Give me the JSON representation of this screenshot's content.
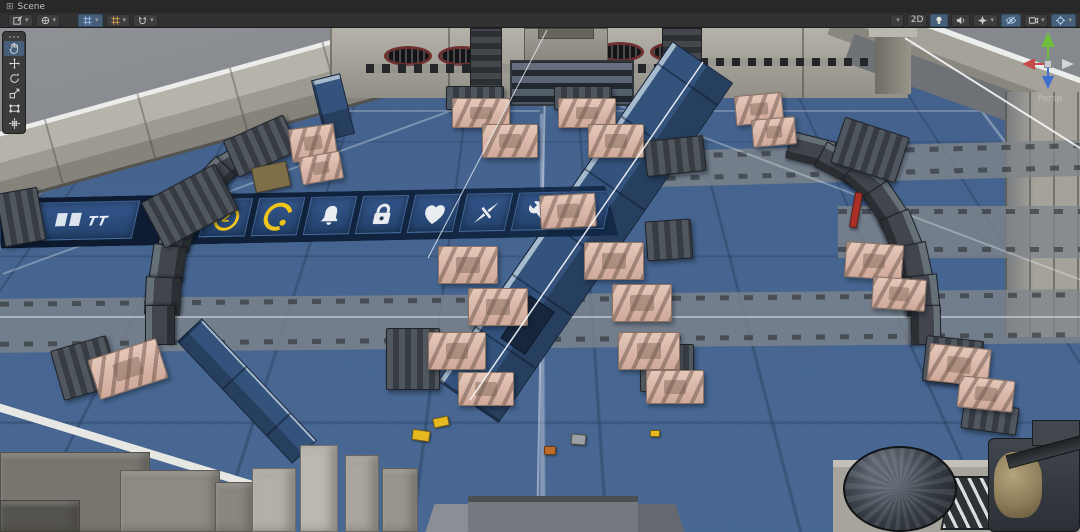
{
  "editor": {
    "tab": {
      "label": "Scene"
    },
    "toolbar": {
      "left": [
        {
          "name": "scene-tool-dropdown",
          "icon": "pencil-square-icon",
          "caret": true
        },
        {
          "name": "gizmo-tool-dropdown",
          "icon": "gizmo-icon",
          "caret": true
        },
        {
          "name": "grid-visibility-dropdown",
          "icon": "grid-icon",
          "active": true,
          "caret": true
        },
        {
          "name": "grid-snap-dropdown",
          "icon": "grid-orange-icon",
          "caret": true
        },
        {
          "name": "snap-settings-dropdown",
          "icon": "magnet-icon",
          "caret": true
        }
      ],
      "right": [
        {
          "name": "shading-mode-dropdown",
          "icon": "sphere-icon",
          "caret": true
        },
        {
          "name": "2d-toggle",
          "label": "2D"
        },
        {
          "name": "lighting-toggle",
          "icon": "bulb-icon",
          "active": true
        },
        {
          "name": "audio-toggle",
          "icon": "speaker-icon"
        },
        {
          "name": "effects-dropdown",
          "icon": "star-icon",
          "caret": true
        },
        {
          "name": "visibility-toggle",
          "icon": "eye-slash-icon",
          "active": true
        },
        {
          "name": "camera-dropdown",
          "icon": "camera-grid-icon",
          "caret": true
        },
        {
          "name": "gizmos-dropdown",
          "icon": "crosshair-icon",
          "active": true,
          "caret": true
        }
      ]
    },
    "tools": {
      "items": [
        {
          "name": "hand",
          "active": true
        },
        {
          "name": "move"
        },
        {
          "name": "rotate"
        },
        {
          "name": "scale"
        },
        {
          "name": "rect"
        },
        {
          "name": "transform"
        }
      ]
    },
    "view_gizmo": {
      "label": "Persp",
      "axis_colors": {
        "up_y": "#6fbf3f",
        "left_x": "#c84b4b",
        "down_z": "#3e6fd0",
        "right": "#d2d5d9"
      }
    }
  },
  "scene": {
    "palette": {
      "floor_blue": "#4a6a96",
      "wall_concrete": "#a5a29a",
      "outside_gray": "#8b8e92",
      "tank_pink": "#d9b3a4",
      "vehicle_dark": "#3a3f45",
      "banner_navy": "#142e4e",
      "tile_blue": "#2c4e7c",
      "accent_yellow": "#f0c419",
      "vent_red": "#6e2f2f",
      "marker_red": "#ab2f26"
    },
    "banner": {
      "text_left": "TT",
      "text_right": "ctrol",
      "icons": [
        {
          "name": "coin-2-icon",
          "value": "2"
        },
        {
          "name": "coin-arc-icon"
        },
        {
          "name": "bell-icon"
        },
        {
          "name": "lock-icon"
        },
        {
          "name": "heart-icon"
        },
        {
          "name": "dart-icon"
        },
        {
          "name": "wrench-icon"
        }
      ]
    },
    "tanks": [
      {
        "x": 290,
        "y": 126,
        "w": 46,
        "h": 34,
        "r": -8
      },
      {
        "x": 300,
        "y": 154,
        "w": 42,
        "h": 28,
        "r": -10
      },
      {
        "x": 452,
        "y": 98,
        "w": 58,
        "h": 30,
        "r": 0
      },
      {
        "x": 482,
        "y": 124,
        "w": 56,
        "h": 34,
        "r": 0
      },
      {
        "x": 558,
        "y": 98,
        "w": 58,
        "h": 30,
        "r": 0
      },
      {
        "x": 588,
        "y": 124,
        "w": 56,
        "h": 34,
        "r": 0
      },
      {
        "x": 735,
        "y": 94,
        "w": 48,
        "h": 30,
        "r": -5
      },
      {
        "x": 752,
        "y": 118,
        "w": 44,
        "h": 28,
        "r": -5
      },
      {
        "x": 438,
        "y": 246,
        "w": 60,
        "h": 38,
        "r": 0
      },
      {
        "x": 468,
        "y": 288,
        "w": 60,
        "h": 38,
        "r": 0
      },
      {
        "x": 584,
        "y": 242,
        "w": 60,
        "h": 38,
        "r": 0
      },
      {
        "x": 612,
        "y": 284,
        "w": 60,
        "h": 38,
        "r": 0
      },
      {
        "x": 428,
        "y": 332,
        "w": 58,
        "h": 38,
        "r": 0
      },
      {
        "x": 458,
        "y": 372,
        "w": 56,
        "h": 34,
        "r": 0
      },
      {
        "x": 618,
        "y": 332,
        "w": 62,
        "h": 38,
        "r": 0
      },
      {
        "x": 646,
        "y": 370,
        "w": 58,
        "h": 34,
        "r": 0
      },
      {
        "x": 92,
        "y": 348,
        "w": 72,
        "h": 42,
        "r": -18
      },
      {
        "x": 845,
        "y": 243,
        "w": 58,
        "h": 36,
        "r": 4
      },
      {
        "x": 872,
        "y": 278,
        "w": 54,
        "h": 32,
        "r": 4
      },
      {
        "x": 928,
        "y": 346,
        "w": 62,
        "h": 38,
        "r": 6
      },
      {
        "x": 958,
        "y": 378,
        "w": 56,
        "h": 32,
        "r": 6
      },
      {
        "x": 540,
        "y": 194,
        "w": 56,
        "h": 34,
        "r": -3
      }
    ],
    "vehicles": [
      {
        "x": 148,
        "y": 180,
        "w": 84,
        "h": 52,
        "r": -28
      },
      {
        "x": 228,
        "y": 126,
        "w": 66,
        "h": 40,
        "r": -24
      },
      {
        "x": 446,
        "y": 86,
        "w": 58,
        "h": 24,
        "r": 0
      },
      {
        "x": 554,
        "y": 86,
        "w": 58,
        "h": 24,
        "r": 0
      },
      {
        "x": 645,
        "y": 138,
        "w": 60,
        "h": 36,
        "r": -6
      },
      {
        "x": 386,
        "y": 328,
        "w": 54,
        "h": 62,
        "r": 0
      },
      {
        "x": 640,
        "y": 344,
        "w": 54,
        "h": 48,
        "r": 0
      },
      {
        "x": 56,
        "y": 342,
        "w": 58,
        "h": 52,
        "r": -16
      },
      {
        "x": 924,
        "y": 338,
        "w": 58,
        "h": 46,
        "r": 6
      },
      {
        "x": 836,
        "y": 126,
        "w": 68,
        "h": 48,
        "r": 18
      },
      {
        "x": 646,
        "y": 220,
        "w": 46,
        "h": 40,
        "r": -4
      },
      {
        "x": 0,
        "y": 190,
        "w": 42,
        "h": 54,
        "r": -10
      },
      {
        "x": 962,
        "y": 404,
        "w": 56,
        "h": 28,
        "r": 8
      }
    ],
    "barrier_left": [
      {
        "x": 240,
        "y": 134,
        "w": 44,
        "h": 26,
        "r": -18
      },
      {
        "x": 214,
        "y": 148,
        "w": 42,
        "h": 26,
        "r": -32
      },
      {
        "x": 192,
        "y": 166,
        "w": 40,
        "h": 28,
        "r": -46
      },
      {
        "x": 174,
        "y": 190,
        "w": 38,
        "h": 30,
        "r": -60
      },
      {
        "x": 160,
        "y": 216,
        "w": 36,
        "h": 32,
        "r": -72
      },
      {
        "x": 150,
        "y": 246,
        "w": 36,
        "h": 34,
        "r": -82
      },
      {
        "x": 144,
        "y": 278,
        "w": 38,
        "h": 36,
        "r": -87
      },
      {
        "x": 140,
        "y": 310,
        "w": 40,
        "h": 30,
        "r": -90
      }
    ],
    "barrier_right": [
      {
        "x": 788,
        "y": 136,
        "w": 46,
        "h": 28,
        "r": 14
      },
      {
        "x": 818,
        "y": 150,
        "w": 44,
        "h": 28,
        "r": 28
      },
      {
        "x": 846,
        "y": 168,
        "w": 42,
        "h": 28,
        "r": 42
      },
      {
        "x": 866,
        "y": 190,
        "w": 40,
        "h": 30,
        "r": 56
      },
      {
        "x": 882,
        "y": 216,
        "w": 38,
        "h": 32,
        "r": 68
      },
      {
        "x": 894,
        "y": 246,
        "w": 38,
        "h": 34,
        "r": 78
      },
      {
        "x": 902,
        "y": 278,
        "w": 40,
        "h": 34,
        "r": 84
      },
      {
        "x": 906,
        "y": 310,
        "w": 40,
        "h": 30,
        "r": 89
      }
    ],
    "pickups": [
      {
        "x": 433,
        "y": 417,
        "w": 16,
        "h": 10,
        "r": -12,
        "c": "#e6b822"
      },
      {
        "x": 412,
        "y": 430,
        "w": 18,
        "h": 11,
        "r": 8,
        "c": "#e6b822"
      },
      {
        "x": 650,
        "y": 430,
        "w": 10,
        "h": 7,
        "r": 0,
        "c": "#e6b822"
      },
      {
        "x": 544,
        "y": 446,
        "w": 12,
        "h": 9,
        "r": 0,
        "c": "#c06a2a"
      },
      {
        "x": 571,
        "y": 434,
        "w": 15,
        "h": 11,
        "r": 5,
        "c": "#9aa0a6"
      }
    ],
    "props": [
      {
        "name": "excavator",
        "x": 253,
        "y": 164,
        "w": 36,
        "h": 26,
        "r": -12,
        "c": "#7e6f49"
      },
      {
        "name": "red-marker",
        "x": 852,
        "y": 192,
        "w": 8,
        "h": 36,
        "r": 10,
        "c": "#ab2f26"
      }
    ]
  }
}
